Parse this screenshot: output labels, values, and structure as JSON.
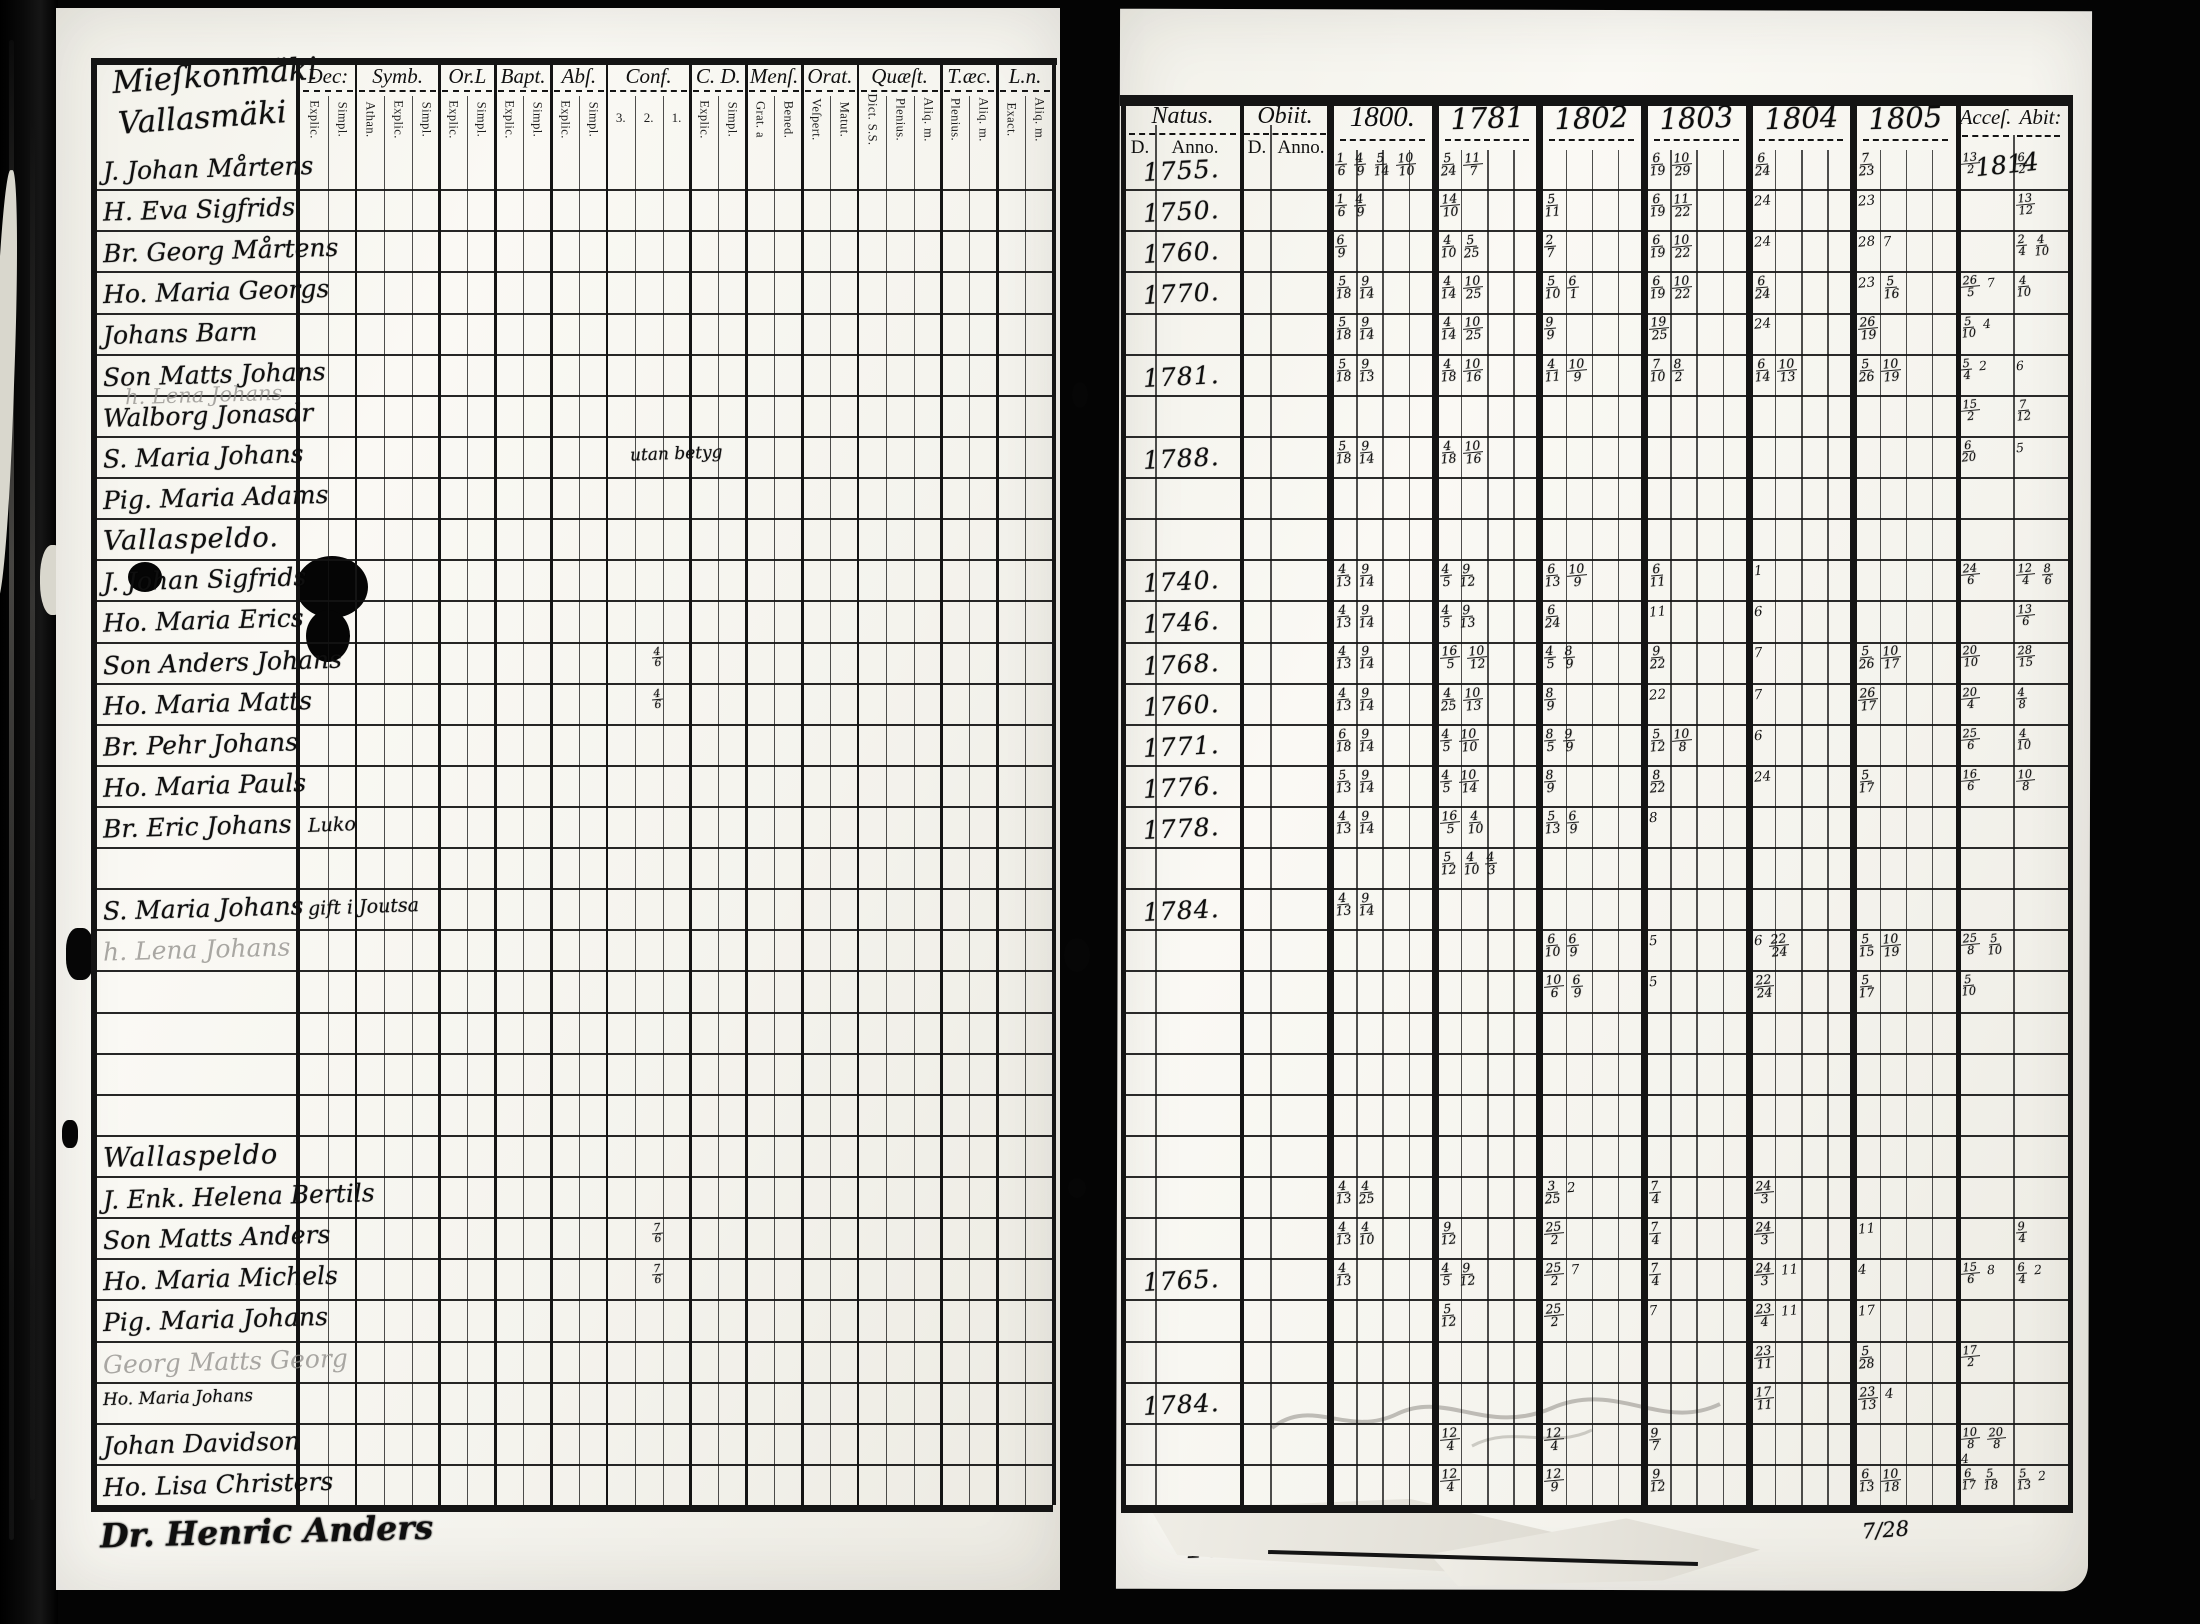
{
  "left_page": {
    "titles": [
      "Mieſkonmäki",
      "Vallasmäki"
    ],
    "column_groups": [
      {
        "label": "Dec:",
        "subs": [
          "Explic.",
          "Simpl."
        ]
      },
      {
        "label": "Symb.",
        "subs": [
          "Athan.",
          "Explic.",
          "Simpl."
        ]
      },
      {
        "label": "Or.L",
        "subs": [
          "Explic.",
          "Simpl."
        ]
      },
      {
        "label": "Bapt.",
        "subs": [
          "Explic.",
          "Simpl."
        ]
      },
      {
        "label": "Abſ.",
        "subs": [
          "Explic.",
          "Simpl."
        ]
      },
      {
        "label": "Conf.",
        "subs": [
          "3.",
          "2.",
          "1."
        ]
      },
      {
        "label": "C. D.",
        "subs": [
          "Explic.",
          "Simpl."
        ]
      },
      {
        "label": "Menſ.",
        "subs": [
          "Grat. a",
          "Bened."
        ]
      },
      {
        "label": "Orat.",
        "subs": [
          "Veſpert.",
          "Matut."
        ]
      },
      {
        "label": "Quæſt.",
        "subs": [
          "Dict. S.S.",
          "Plenius.",
          "Aliq. m."
        ]
      },
      {
        "label": "T.æc.",
        "subs": [
          "Plenius.",
          "Aliq. m."
        ]
      },
      {
        "label": "L.n.",
        "subs": [
          "Exact.",
          "Aliq. m."
        ]
      }
    ],
    "rows": [
      {
        "name": "J. Johan Mårtens"
      },
      {
        "name": "H. Eva Sigfrids"
      },
      {
        "name": "Br. Georg Mårtens"
      },
      {
        "name": "Ho. Maria Georgs"
      },
      {
        "name": "Johans Barn"
      },
      {
        "name": "Son Matts Johans"
      },
      {
        "name": "Walborg Jonasdr",
        "overlay": "h. Lena Johans"
      },
      {
        "name": "S. Maria Johans",
        "center_note": "utan betyg"
      },
      {
        "name": "Pig. Maria Adams"
      },
      {
        "name": "Vallaspeldo.",
        "heading": true
      },
      {
        "name": "J. Johan Sigfrids"
      },
      {
        "name": "Ho. Maria Erics"
      },
      {
        "name": "Son Anders Johans",
        "conf_note": "4/6"
      },
      {
        "name": "Ho. Maria Matts",
        "conf_note": "4/6"
      },
      {
        "name": "Br. Pehr Johans"
      },
      {
        "name": "Ho. Maria Pauls"
      },
      {
        "name": "Br. Eric Johans",
        "dec_note": "Luko"
      },
      {
        "name": ""
      },
      {
        "name": "S. Maria Johans",
        "dec_note": "gift i Joutsa"
      },
      {
        "name": "h. Lena Johans",
        "faint": true
      },
      {
        "name": ""
      },
      {
        "name": ""
      },
      {
        "name": ""
      },
      {
        "name": ""
      },
      {
        "name": "Wallaspeldo",
        "heading": true
      },
      {
        "name": "J. Enk. Helena Bertils"
      },
      {
        "name": "Son Matts Anders",
        "conf_note": "7/6"
      },
      {
        "name": "Ho. Maria Michels",
        "conf_note": "7/6"
      },
      {
        "name": "Pig. Maria Johans"
      },
      {
        "name": "Georg Matts Georg",
        "faint": true
      },
      {
        "name": "Ho. Maria Johans",
        "small": true
      },
      {
        "name": "Johan Davidson"
      },
      {
        "name": "Ho. Lisa Christers"
      }
    ],
    "footer_name": "Dr. Henric Anders"
  },
  "right_page": {
    "headers": {
      "natus": "Natus.",
      "obiit": "Obiit.",
      "d": "D.",
      "anno": "Anno.",
      "years": [
        "1800.",
        "1781",
        "1802",
        "1803",
        "1804",
        "1805"
      ],
      "acces": "Acceſ.",
      "abit": "Abit:",
      "acces_note": "1814"
    },
    "rows": [
      {
        "natus": "1755.",
        "y1800": "1/6 4/9 5/14 10/10",
        "y1781": "5/24 11/7",
        "y1803": "6/19 10/29",
        "y1804": "6/24",
        "y1805": "7/23",
        "acces": "13/2",
        "abit": "6/2"
      },
      {
        "natus": "1750.",
        "y1800": "1/6 4/9",
        "y1781": "14/10",
        "y1802": "5/11",
        "y1803": "6/19 11/22",
        "y1804": "24",
        "y1805": "23",
        "abit": "13/12"
      },
      {
        "natus": "1760.",
        "y1800": "6/9",
        "y1781": "4/10 5/25",
        "y1802": "2/7",
        "y1803": "6/19 10/22",
        "y1804": "24",
        "y1805": "28 7",
        "abit": "2/4 4/10"
      },
      {
        "natus": "1770.",
        "y1800": "5/18 9/14",
        "y1781": "4/14 10/25",
        "y1802": "5/10 6/1",
        "y1803": "6/19 10/22",
        "y1804": "6/24",
        "y1805": "23 5/16",
        "acces": "26/5 7",
        "abit": "4/10"
      },
      {
        "y1800": "5/18 9/14",
        "y1781": "4/14 10/25",
        "y1802": "9/9",
        "y1803": "19/25",
        "y1804": "24",
        "y1805": "26/19",
        "acces": "5/10 4"
      },
      {
        "natus": "1781.",
        "y1800": "5/18 9/13",
        "y1781": "4/18 10/16",
        "y1802": "4/11 10/9",
        "y1803": "7/10 8/2",
        "y1804": "6/14 10/13",
        "y1805": "5/26 10/19",
        "acces": "5/4 2",
        "abit": "6"
      },
      {
        "acces": "15/2",
        "abit": "7/12"
      },
      {
        "natus": "1788.",
        "y1800": "5/18 9/14",
        "y1781": "4/18 10/16",
        "acces": "6/20",
        "abit": "5"
      },
      {},
      {},
      {
        "natus": "1740.",
        "y1800": "4/13 9/14",
        "y1781": "4/5 9/12",
        "y1802": "6/13 10/9",
        "y1803": "6/11",
        "y1804": "1",
        "acces": "24/6",
        "abit": "12/4 8/6"
      },
      {
        "natus": "1746.",
        "y1800": "4/13 9/14",
        "y1781": "4/5 9/13",
        "y1802": "6/24",
        "y1803": "11",
        "y1804": "6",
        "abit": "13/6"
      },
      {
        "natus": "1768.",
        "y1800": "4/13 9/14",
        "y1781": "16/5 10/12",
        "y1802": "4/5 8/9",
        "y1803": "9/22",
        "y1804": "7",
        "y1805": "5/26 10/17",
        "acces": "20/10",
        "abit": "28/15"
      },
      {
        "natus": "1760.",
        "y1800": "4/13 9/14",
        "y1781": "4/25 10/13",
        "y1802": "8/9",
        "y1803": "22",
        "y1804": "7",
        "y1805": "26/17",
        "acces": "20/4",
        "abit": "4/8"
      },
      {
        "natus": "1771.",
        "y1800": "6/18 9/14",
        "y1781": "4/5 10/10",
        "y1802": "8/5 9/9",
        "y1803": "5/12 10/8",
        "y1804": "6",
        "acces": "25/6",
        "abit": "4/10"
      },
      {
        "natus": "1776.",
        "y1800": "5/13 9/14",
        "y1781": "4/5 10/14",
        "y1802": "8/9",
        "y1803": "8/22",
        "y1804": "24",
        "y1805": "5/17",
        "acces": "16/6",
        "abit": "10/8"
      },
      {
        "natus": "1778.",
        "y1800": "4/13 9/14",
        "y1781": "16/5 4/10",
        "y1802": "5/13 6/9",
        "y1803": "8"
      },
      {
        "y1781": "5/12 4/10 4/3"
      },
      {
        "natus": "1784.",
        "y1800": "4/13 9/14"
      },
      {
        "y1802": "6/10 6/9",
        "y1803": "5",
        "y1804": "6 22/24",
        "y1805": "5/15 10/19",
        "acces": "25/8 5/10"
      },
      {
        "y1802": "10/6 6/9",
        "y1803": "5",
        "y1804": "22/24",
        "y1805": "5/17",
        "acces": "5/10"
      },
      {},
      {},
      {},
      {},
      {
        "y1800": "4/13 4/25",
        "y1802": "3/25 2",
        "y1803": "7/4",
        "y1804": "24/3"
      },
      {
        "y1800": "4/13 4/10",
        "y1781": "9/12",
        "y1802": "25/2",
        "y1803": "7/4",
        "y1804": "24/3",
        "y1805": "11",
        "abit": "9/4"
      },
      {
        "natus": "1765.",
        "y1800": "4/13",
        "y1781": "4/5 9/12",
        "y1802": "25/2 7",
        "y1803": "7/4",
        "y1804": "24/3 11",
        "y1805": "4",
        "acces": "15/6 8",
        "abit": "6/4 2"
      },
      {
        "y1781": "5/12",
        "y1802": "25/2",
        "y1803": "7",
        "y1804": "23/4 11",
        "y1805": "17"
      },
      {
        "y1804": "23/11",
        "y1805": "5/28",
        "acces": "17/2"
      },
      {
        "natus": "1784.",
        "y1804": "17/11",
        "y1805": "23/13 4"
      },
      {
        "y1781": "12/4",
        "y1802": "12/4",
        "y1803": "9/7",
        "acces": "10/8 20/8 4"
      },
      {
        "y1781": "12/4",
        "y1802": "12/9",
        "y1803": "9/12",
        "y1805": "6/13 10/18",
        "acces": "6/17 5/18",
        "abit": "5/13 2"
      }
    ],
    "footer": {
      "natus": "1798",
      "mark": "7/28"
    }
  }
}
